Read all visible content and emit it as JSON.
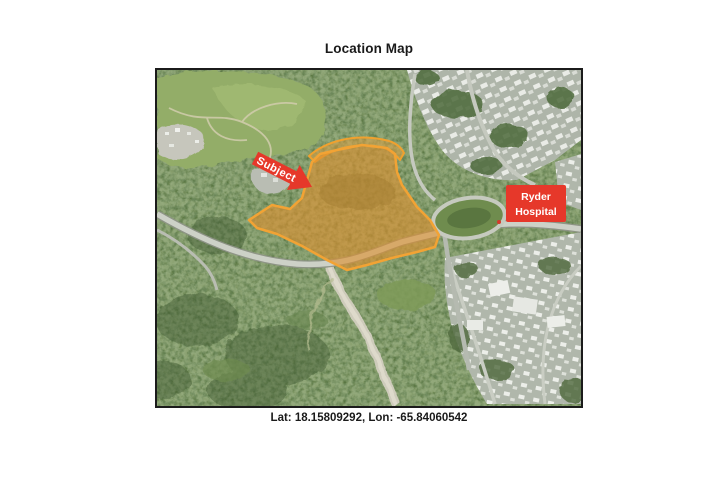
{
  "page": {
    "title": "Location Map",
    "caption": "Lat: 18.15809292, Lon: -65.84060542"
  },
  "map": {
    "subject_label": "Subject",
    "hospital_label": [
      "Ryder",
      "Hospital"
    ],
    "colors": {
      "parcel_fill": "#DD8F2F",
      "parcel_stroke": "#F2A334",
      "callout_red": "#E6382A",
      "label_text": "#FFFFFF"
    }
  }
}
